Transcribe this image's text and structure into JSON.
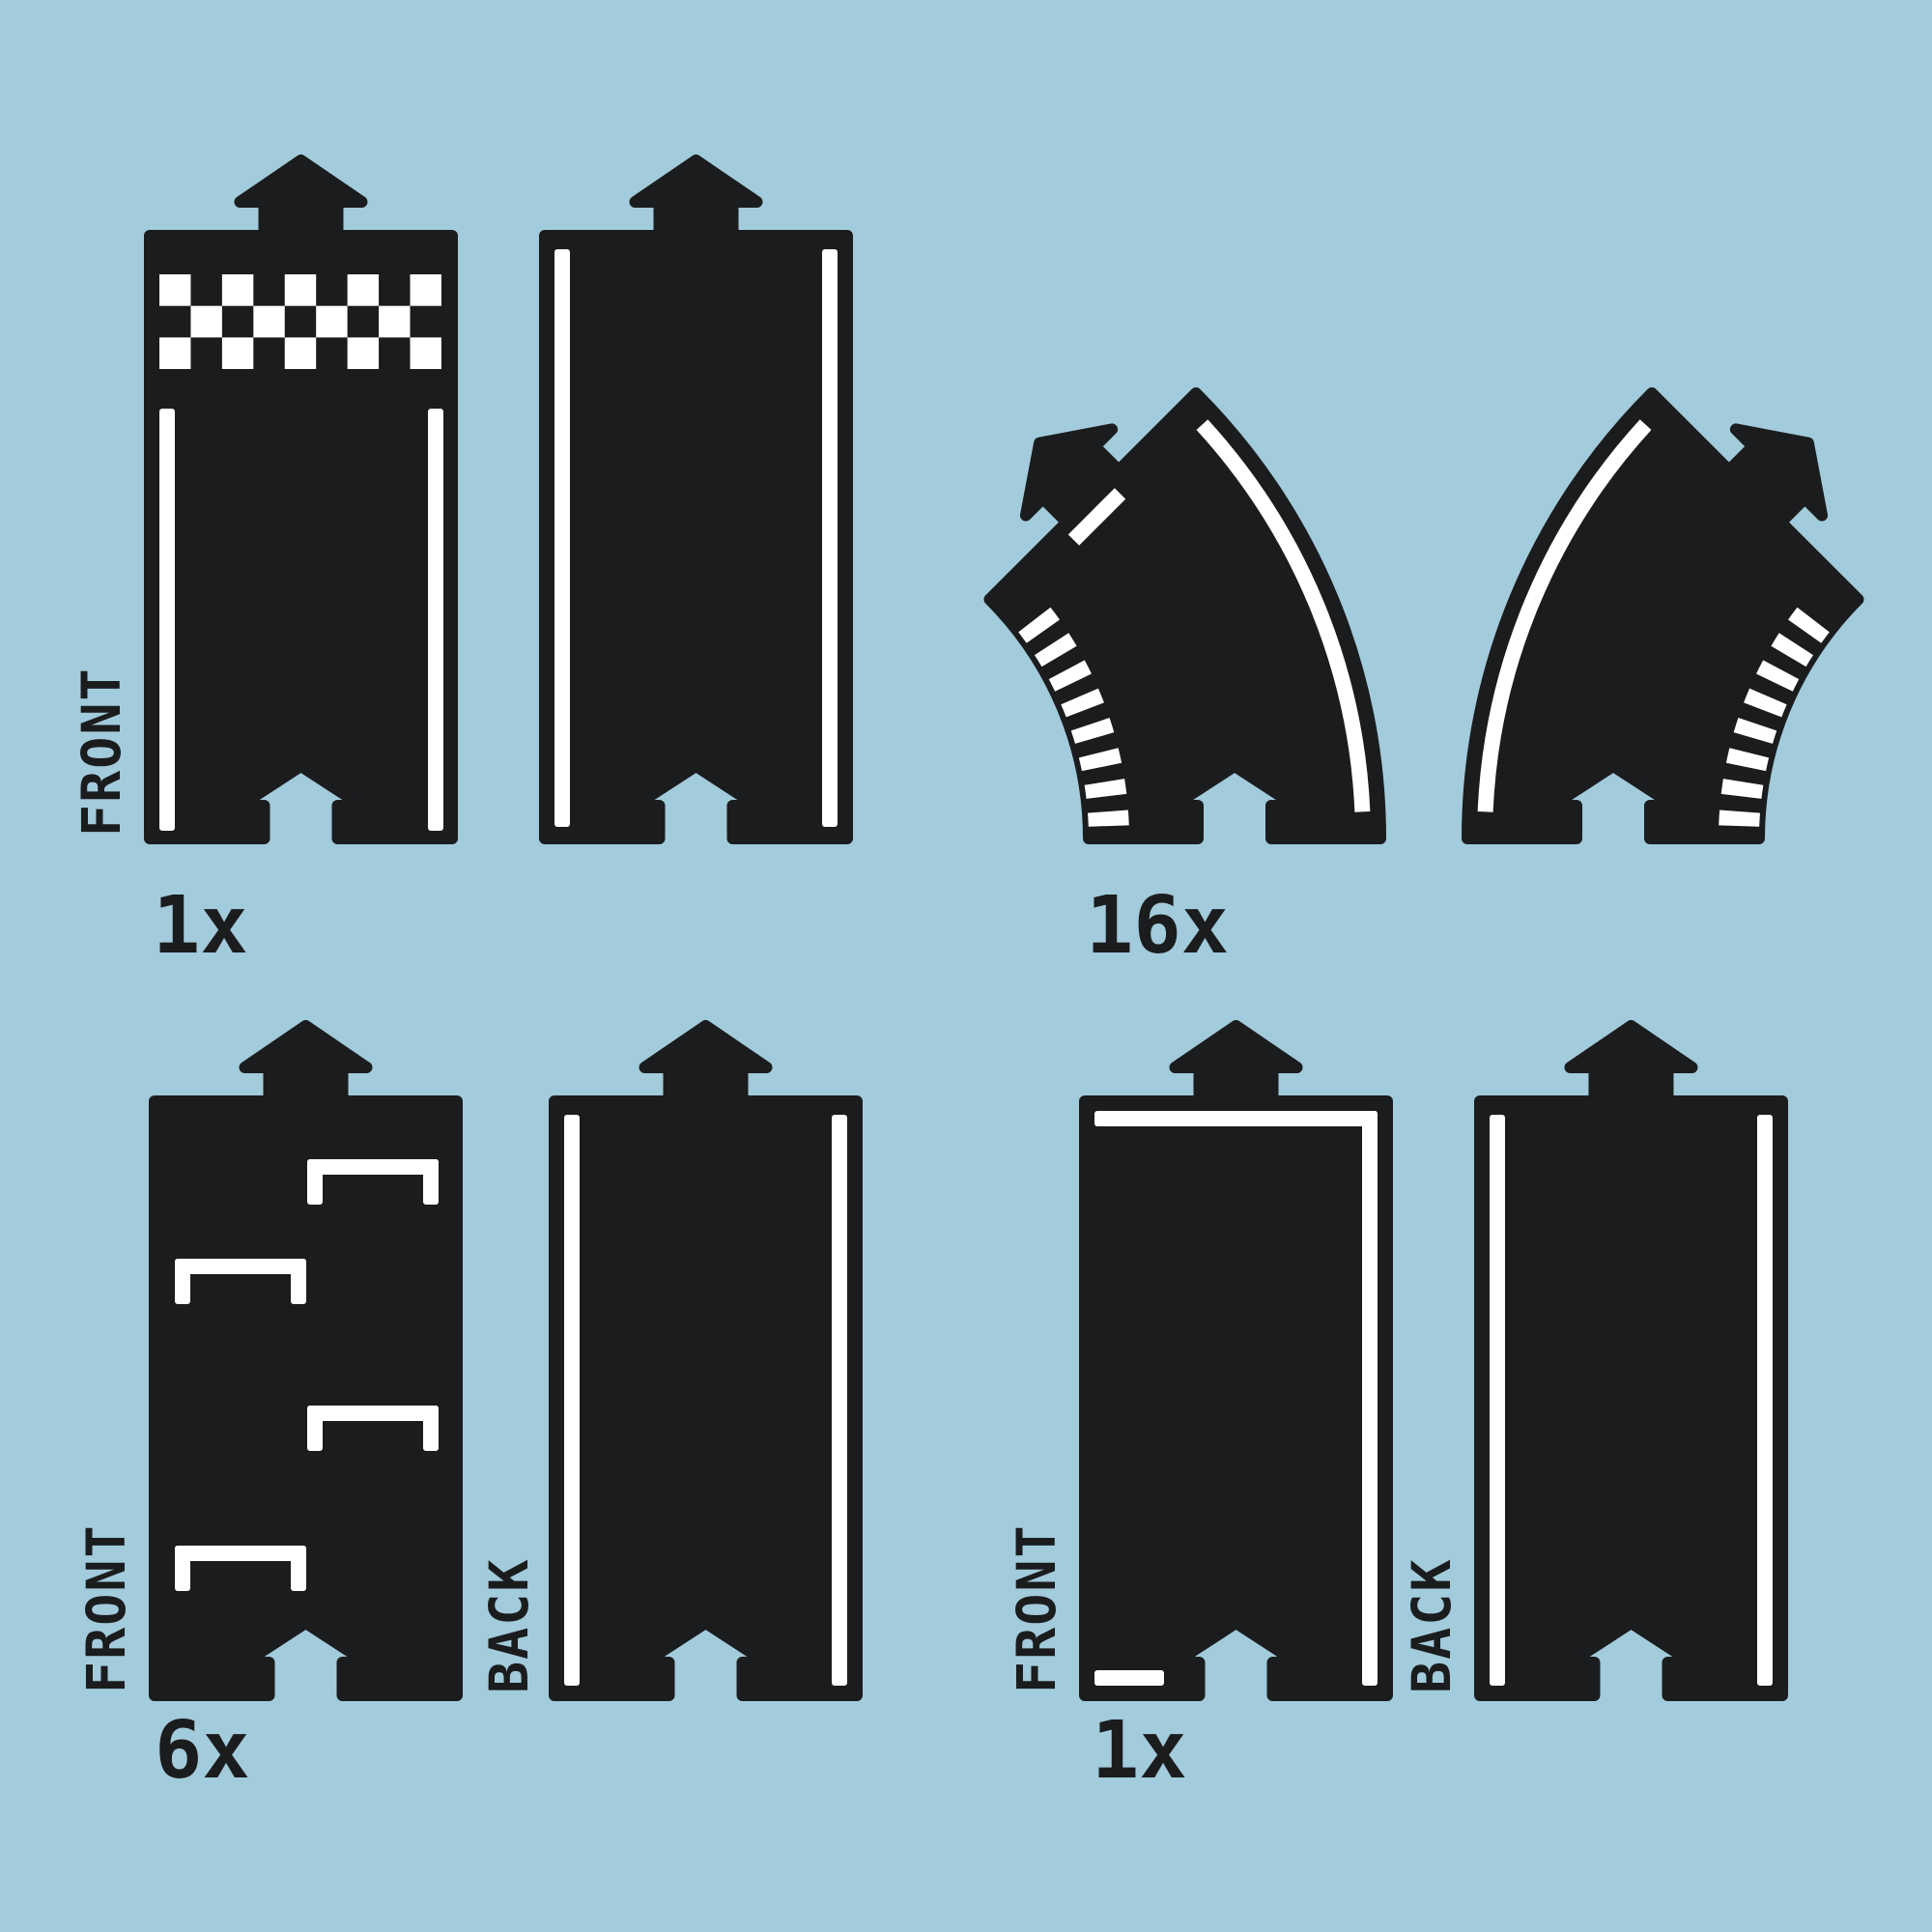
{
  "title": "toy-road-track-parts-diagram",
  "colors": {
    "background": "#a2cbdb",
    "piece": "#1b1c1e",
    "marking": "#ffffff",
    "text": "#1b1c1e"
  },
  "groups": {
    "finish": {
      "front_label": "FRONT",
      "back_label": "BACK",
      "count": "1x"
    },
    "curve": {
      "count": "16x"
    },
    "parking": {
      "front_label": "FRONT",
      "back_label": "BACK",
      "count": "6x"
    },
    "border": {
      "front_label": "FRONT",
      "back_label": "BACK",
      "count": "1x"
    }
  },
  "pieces": {
    "finish_front": "straight-with-checkered-finish-line",
    "finish_back": "straight-with-edge-lines",
    "curve_left": "45-degree-curve-left",
    "curve_right": "45-degree-curve-right",
    "parking_front": "straight-with-parking-bays",
    "parking_back": "straight-with-edge-lines",
    "border_front": "straight-with-perimeter-border-line",
    "border_back": "straight-with-edge-lines"
  }
}
